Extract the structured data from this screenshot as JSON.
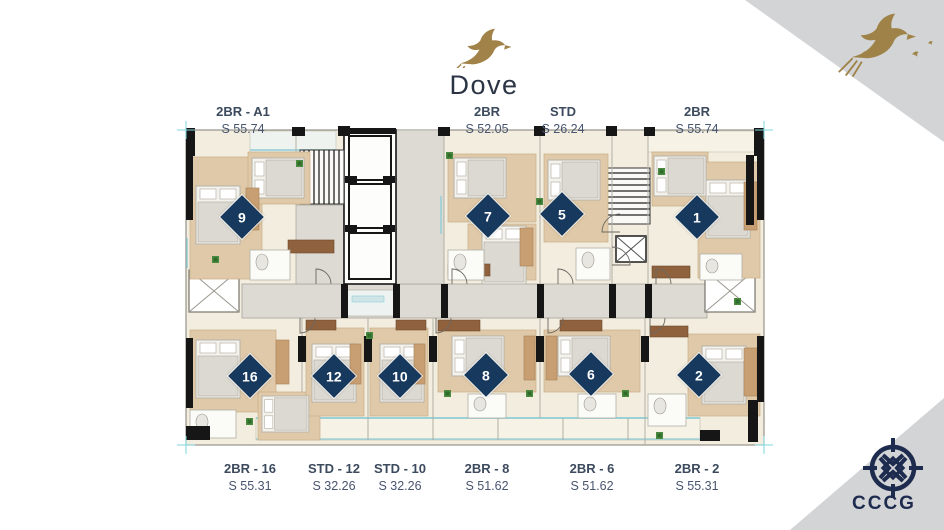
{
  "logo": {
    "name": "Dove",
    "icon": "dove-icon"
  },
  "brand": {
    "gold": "#a18349",
    "navy": "#17395e",
    "panel_gray": "#d3d4d6",
    "cccg_navy": "#1d2b4e",
    "label_color": "#3c4a5e",
    "floor_cream": "#f2edde",
    "corridor_gray": "#dcdad3",
    "glass_cyan": "#8ecdd6"
  },
  "footer": {
    "cccg_text": "CCCG",
    "icon": "cccg-compass-icon"
  },
  "corner_art": {
    "icon": "dove-flock-icon"
  },
  "plan": {
    "marker_color": "#17395e",
    "top_labels": [
      {
        "name": "2BR - A1",
        "area": "S 55.74",
        "x": 243
      },
      {
        "name": "2BR",
        "area": "S 52.05",
        "x": 487
      },
      {
        "name": "STD",
        "area": "S 26.24",
        "x": 563
      },
      {
        "name": "2BR",
        "area": "S 55.74",
        "x": 697
      }
    ],
    "bottom_labels": [
      {
        "name": "2BR - 16",
        "area": "S 55.31",
        "x": 250
      },
      {
        "name": "STD - 12",
        "area": "S 32.26",
        "x": 334
      },
      {
        "name": "STD - 10",
        "area": "S 32.26",
        "x": 400
      },
      {
        "name": "2BR - 8",
        "area": "S 51.62",
        "x": 487
      },
      {
        "name": "2BR - 6",
        "area": "S 51.62",
        "x": 592
      },
      {
        "name": "2BR - 2",
        "area": "S 55.31",
        "x": 697
      }
    ],
    "unit_markers": [
      {
        "number": "9",
        "x": 242,
        "y": 217
      },
      {
        "number": "7",
        "x": 488,
        "y": 216
      },
      {
        "number": "5",
        "x": 562,
        "y": 214
      },
      {
        "number": "1",
        "x": 697,
        "y": 217
      },
      {
        "number": "16",
        "x": 250,
        "y": 376
      },
      {
        "number": "12",
        "x": 334,
        "y": 376
      },
      {
        "number": "10",
        "x": 400,
        "y": 376
      },
      {
        "number": "8",
        "x": 486,
        "y": 375
      },
      {
        "number": "6",
        "x": 591,
        "y": 374
      },
      {
        "number": "2",
        "x": 699,
        "y": 375
      }
    ]
  }
}
